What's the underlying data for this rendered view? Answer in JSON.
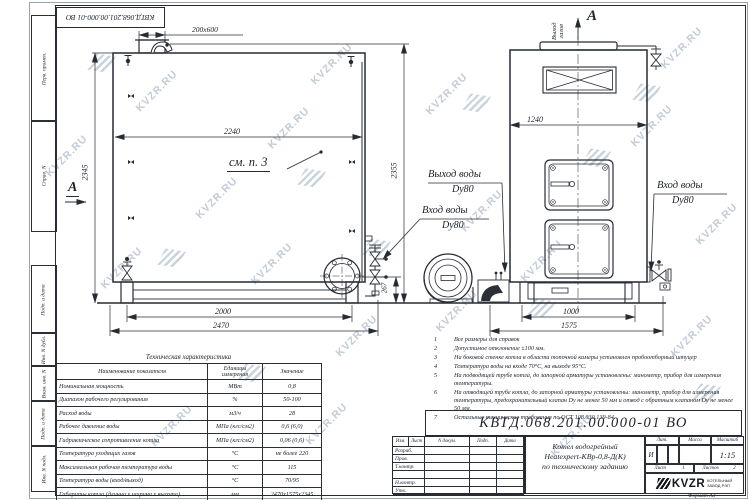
{
  "watermark": {
    "text": "KVZR.RU"
  },
  "doc_number": "КВТД.068.201.00.000-01 ВО",
  "margin_labels": {
    "b1": "Перв. примен.",
    "b2": "Справ. N",
    "b3": "Подп. и дата",
    "b4": "Инв. N дубл.",
    "b5": "Взам. инв. N",
    "b6": "Подп. и дата",
    "b7": "Инв. N подл."
  },
  "drawing": {
    "left_view": {
      "dim_top": "200x600",
      "dim_width": "2240",
      "dim_height_left": "2345",
      "dim_height_right": "2355",
      "dim_pipe_height": "267",
      "dim_base": "2000",
      "dim_total": "2470",
      "see_note": "см. п. 3",
      "section_label": "А"
    },
    "right_view": {
      "dim_width": "1240",
      "dim_base": "1000",
      "dim_total": "1575",
      "gas_outlet_line1": "Выход",
      "gas_outlet_line2": "газов",
      "view_label": "А"
    },
    "labels": {
      "water_out": "Выход воды",
      "water_out_dn": "Dy80",
      "water_in": "Вход воды",
      "water_in_dn": "Dy80",
      "water_in_right": "Вход воды",
      "water_in_right_dn": "Dy80"
    }
  },
  "spec_table": {
    "title": "Техническая характеристика",
    "headers": [
      "Наименование показателя",
      "Единицы измерения",
      "Значение"
    ],
    "rows": [
      [
        "Номинальная мощность",
        "МВт",
        "0,8"
      ],
      [
        "Диапазон рабочего регулирования",
        "%",
        "50-100"
      ],
      [
        "Расход воды",
        "м3/ч",
        "28"
      ],
      [
        "Рабочее давление воды",
        "МПа (кгс/см2)",
        "0,6 (6,0)"
      ],
      [
        "Гидравлическое сопротивление котла",
        "МПа (кгс/см2)",
        "0,06 (0,6)"
      ],
      [
        "Температура уходящих газов",
        "°С",
        "не более 220"
      ],
      [
        "Максимальная рабочая температура воды",
        "°С",
        "115"
      ],
      [
        "Температура воды (вход/выход)",
        "°С",
        "70/95"
      ],
      [
        "Габариты котла (длинна х ширина х высота)",
        "мм",
        "2470х1575х2345"
      ]
    ]
  },
  "notes": [
    {
      "n": "1",
      "t": "Все размеры для справок"
    },
    {
      "n": "2",
      "t": "Допустимое отклонение ±100 мм."
    },
    {
      "n": "3",
      "t": "На боковой стенке котла в области топочной камеры установлен пробоотборный штуцер"
    },
    {
      "n": "4",
      "t": "Температура воды на входе 70°С, на выходе 95°С."
    },
    {
      "n": "5",
      "t": "На подводящей трубе котла, до запорной арматуры установлены: манометр, прибор для измерения температуры."
    },
    {
      "n": "6",
      "t": "На отводящей трубе котла, до запорной арматуры установлены: манометр, прибор для измерения температуры, предохранительный клапан Dy не менее 50 мм и отвод с обратным клапаном Dy не менее 50 мм."
    },
    {
      "n": "7",
      "t": "Остальные технические требования по ОСТ 108.030.139-84."
    }
  ],
  "title_block": {
    "doc_number": "КВТД.068.201.00.000-01 ВО",
    "cols": [
      "Изм.",
      "Лист",
      "N докум.",
      "Подп.",
      "Дата"
    ],
    "rows": [
      "Разраб.",
      "Пров.",
      "Т.контр.",
      "",
      "Н.контр.",
      "Утв."
    ],
    "description": [
      "Котел водогрейный",
      "Heatexpert-КВр-0,8-Д(К)",
      "по техническому заданию"
    ],
    "lit": {
      "label": "Лит.",
      "value": "И"
    },
    "mass": {
      "label": "Масса",
      "value": ""
    },
    "scale": {
      "label": "Масштаб",
      "value": "1:15"
    },
    "sheet": {
      "label": "Лист",
      "value": "1"
    },
    "sheets": {
      "label": "Листов",
      "value": "2"
    },
    "company": {
      "logo_text": "KVZR",
      "line1": "КОТЕЛЬНЫЙ",
      "line2": "ЗАВОД РЭП"
    },
    "format": "Формат А3"
  }
}
